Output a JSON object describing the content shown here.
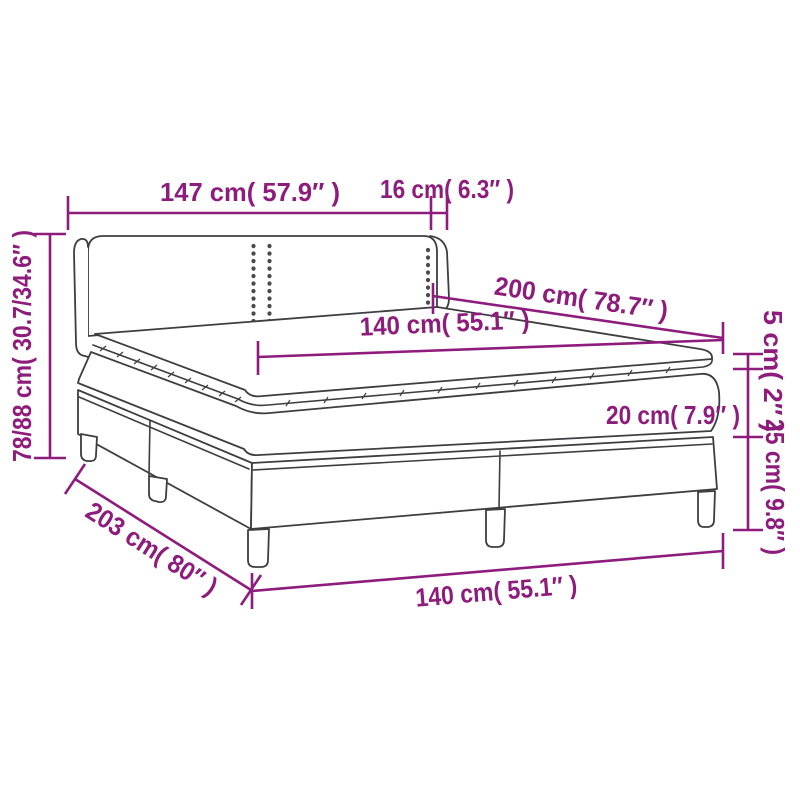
{
  "diagram": {
    "title": "box-spring-bed-dimension-diagram",
    "colors": {
      "accent": "#8e1c7c",
      "line": "#3e3e40",
      "background": "#ffffff"
    },
    "labels": {
      "headboard_width": "147 cm( 57.9″ )",
      "wing_depth": "16 cm( 6.3″ )",
      "total_height": "78/88 cm( 30.7/34.6″ )",
      "bed_length": "200 cm( 78.7″ )",
      "mattress_width_top": "140 cm( 55.1″ )",
      "topper_height": "5 cm( 2″ )",
      "mattress_height": "20 cm( 7.9″ )",
      "base_height": "25 cm( 9.8″ )",
      "total_length": "203 cm( 80″ )",
      "bed_width_bottom": "140 cm( 55.1″ )"
    }
  }
}
